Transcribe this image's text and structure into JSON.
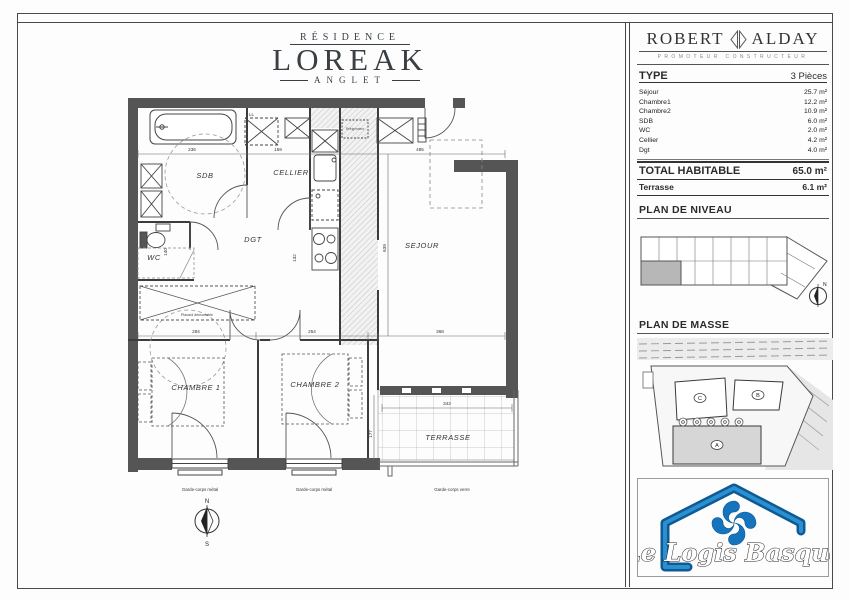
{
  "header": {
    "residence": "RÉSIDENCE",
    "name": "LOREAK",
    "city": "ANGLET"
  },
  "panel": {
    "builder": {
      "name_left": "ROBERT",
      "name_right": "ALDAY",
      "subtitle": "PROMOTEUR CONSTRUCTEUR"
    },
    "type_label": "TYPE",
    "type_value": "3 Pièces",
    "rooms": [
      {
        "name": "Séjour",
        "area": "25.7 m²"
      },
      {
        "name": "Chambre1",
        "area": "12.2 m²"
      },
      {
        "name": "Chambre2",
        "area": "10.9 m²"
      },
      {
        "name": "SDB",
        "area": "6.0 m²"
      },
      {
        "name": "WC",
        "area": "2.0 m²"
      },
      {
        "name": "Cellier",
        "area": "4.2 m²"
      },
      {
        "name": "Dgt",
        "area": "4.0 m²"
      }
    ],
    "total_label": "TOTAL HABITABLE",
    "total_value": "65.0 m²",
    "terrasse_label": "Terrasse",
    "terrasse_value": "6.1 m²",
    "niveau_title": "PLAN DE NIVEAU",
    "masse_title": "PLAN DE MASSE",
    "masse_buildings": {
      "a": "A",
      "b": "B",
      "c": "C"
    },
    "brand_name": "Le Logis Basque",
    "colors": {
      "brand_blue": "#1574bd",
      "wall_gray": "#555555"
    }
  },
  "plan": {
    "rooms": {
      "sdb": "SDB",
      "cellier": "CELLIER",
      "dgt": "DGT",
      "sejour": "SEJOUR",
      "wc": "WC",
      "chambre1": "CHAMBRE 1",
      "chambre2": "CHAMBRE 2",
      "terrasse": "TERRASSE"
    },
    "dims": {
      "sdb_width": "236",
      "cellier_width": "159",
      "sejour_width": "485",
      "sejour_height": "639",
      "dgt_width": "132",
      "wc_height": "140",
      "chambre1_width": "284",
      "chambre2_width": "254",
      "sejour_bottom_width": "368",
      "terrasse_width": "343",
      "terrasse_height": "177"
    },
    "annotations": {
      "placard": "Placard démontable",
      "laundry": "LL",
      "fridge": "Réfrigérateur",
      "garde_corps_1": "Garde-corps métal",
      "garde_corps_2": "Garde-corps métal",
      "garde_corps_3": "Garde-corps verre"
    },
    "compass": {
      "north": "N",
      "south": "S"
    }
  }
}
